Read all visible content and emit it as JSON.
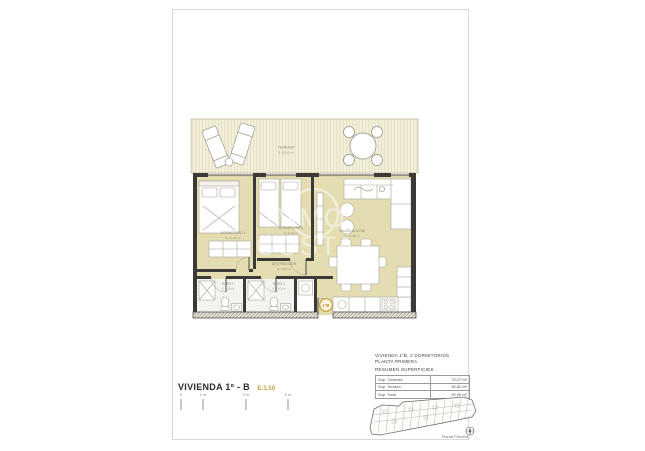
{
  "sheet": {
    "title": "VIVIENDA 1º - B",
    "scale": "E:1.50"
  },
  "plan": {
    "badge": "1ºB",
    "watermark": {
      "line1": "IMMO",
      "line2": "COSTA"
    },
    "rooms": {
      "terraza": {
        "label": "TERRAZA",
        "area": "S: 25,82 m²"
      },
      "dormitorio1": {
        "label": "DORMITORIO 1",
        "area": "S: 12,15 m²"
      },
      "dormitorio2": {
        "label": "DORMITORIO 2",
        "area": "S: 9,40 m²"
      },
      "salon": {
        "label": "SALÓN-COCINA",
        "area": "S: 21,38 m²"
      },
      "distribuidor": {
        "label": "DISTRIBUIDOR",
        "area": "S: 2,80 m²"
      },
      "bano1": {
        "label": "BAÑO 1",
        "area": "S: 3,60 m²"
      },
      "bano2": {
        "label": "BAÑO 2",
        "area": "S: 3,60 m²"
      }
    }
  },
  "summary": {
    "line1": "VIVIENDA 1ºB. 2 DORMITORIOS",
    "line2": "PLANTA PRIMERA",
    "line3": "RESUMEN SUPERFICIES",
    "rows": [
      {
        "label": "Sup. Vivienda",
        "value": "73,27 m²"
      },
      {
        "label": "Sup. Terraza",
        "value": "25,82 m²"
      },
      {
        "label": "Sup. Total",
        "value": "99,09 m²"
      }
    ]
  },
  "scalebar": {
    "ticks": [
      "0",
      "1 m",
      "3 m",
      "5 m"
    ]
  },
  "keyplan": {
    "caption": "Planta Primera"
  },
  "colors": {
    "accent": "#c49b3c",
    "floor": "#e4ddb2",
    "terrace": "#f2efdc",
    "wall": "#3b3a37"
  }
}
